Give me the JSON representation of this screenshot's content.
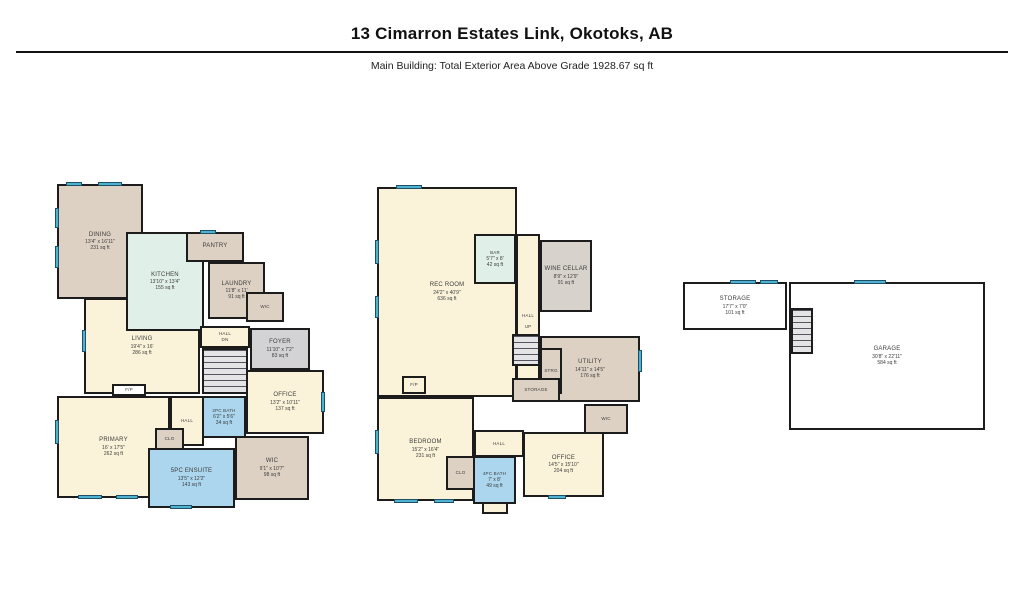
{
  "header": {
    "title": "13 Cimarron Estates Link, Okotoks, AB",
    "subtitle": "Main Building: Total Exterior Area Above Grade 1928.67 sq ft"
  },
  "palette": {
    "wall": "#1c1c1c",
    "room_cream": "#fbf3d9",
    "room_tan": "#ddd1c3",
    "room_mint": "#e1efe9",
    "room_blue": "#abd6ee",
    "room_gray": "#d3d3d5",
    "window_marker": "#4fb3cf"
  },
  "plans": {
    "main": {
      "rooms": {
        "dining": {
          "name": "DINING",
          "dims": "13'4\" x 16'11\"",
          "area": "231 sq ft"
        },
        "kitchen": {
          "name": "KITCHEN",
          "dims": "13'10\" x 13'4\"",
          "area": "155 sq ft"
        },
        "pantry": {
          "name": "PANTRY"
        },
        "laundry": {
          "name": "LAUNDRY",
          "dims": "11'8\" x 11'",
          "area": "91 sq ft"
        },
        "wic_laundry": {
          "name": "WIC"
        },
        "living": {
          "name": "LIVING",
          "dims": "19'4\" x 16'",
          "area": "286 sq ft"
        },
        "hall_upper": {
          "name": "HALL",
          "note": "DN"
        },
        "foyer": {
          "name": "FOYER",
          "dims": "11'10\" x 7'2\"",
          "area": "83 sq ft"
        },
        "office": {
          "name": "OFFICE",
          "dims": "13'2\" x 10'11\"",
          "area": "137 sq ft"
        },
        "bath2pc": {
          "name": "2PC BATH",
          "dims": "6'2\" x 5'6\"",
          "area": "34 sq ft"
        },
        "primary": {
          "name": "PRIMARY",
          "dims": "16' x 17'5\"",
          "area": "262 sq ft"
        },
        "hall_lower": {
          "name": "HALL"
        },
        "clo": {
          "name": "CLO"
        },
        "ensuite": {
          "name": "5PC ENSUITE",
          "dims": "13'5\" x 12'2\"",
          "area": "143 sq ft"
        },
        "wic_primary": {
          "name": "WIC",
          "dims": "9'1\" x 10'7\"",
          "area": "98 sq ft"
        },
        "fireplace": {
          "name": "F/P"
        }
      }
    },
    "basement": {
      "rooms": {
        "rec_room": {
          "name": "REC ROOM",
          "dims": "24'2\" x 40'9\"",
          "area": "636 sq ft"
        },
        "bar": {
          "name": "BAR",
          "dims": "5'7\" x 8'",
          "area": "42 sq ft"
        },
        "hall": {
          "name": "HALL"
        },
        "wine_cellar": {
          "name": "WINE CELLAR",
          "dims": "8'9\" x 12'9\"",
          "area": "91 sq ft"
        },
        "up": {
          "name": "UP"
        },
        "utility": {
          "name": "UTILITY",
          "dims": "14'11\" x 14'5\"",
          "area": "176 sq ft"
        },
        "strg": {
          "name": "STRG"
        },
        "storage": {
          "name": "STORAGE"
        },
        "wic": {
          "name": "WIC"
        },
        "bedroom": {
          "name": "BEDROOM",
          "dims": "15'2\" x 16'4\"",
          "area": "231 sq ft"
        },
        "hall_lower": {
          "name": "HALL"
        },
        "clo": {
          "name": "CLO"
        },
        "bath4pc": {
          "name": "4PC BATH",
          "dims": "7' x 8'",
          "area": "49 sq ft"
        },
        "office": {
          "name": "OFFICE",
          "dims": "14'5\" x 15'10\"",
          "area": "204 sq ft"
        },
        "fireplace": {
          "name": "F/P"
        }
      }
    },
    "garage": {
      "rooms": {
        "storage": {
          "name": "STORAGE",
          "dims": "17'7\" x 7'0\"",
          "area": "101 sq ft"
        },
        "garage": {
          "name": "GARAGE",
          "dims": "30'8\" x 22'11\"",
          "area": "584 sq ft"
        }
      }
    }
  }
}
